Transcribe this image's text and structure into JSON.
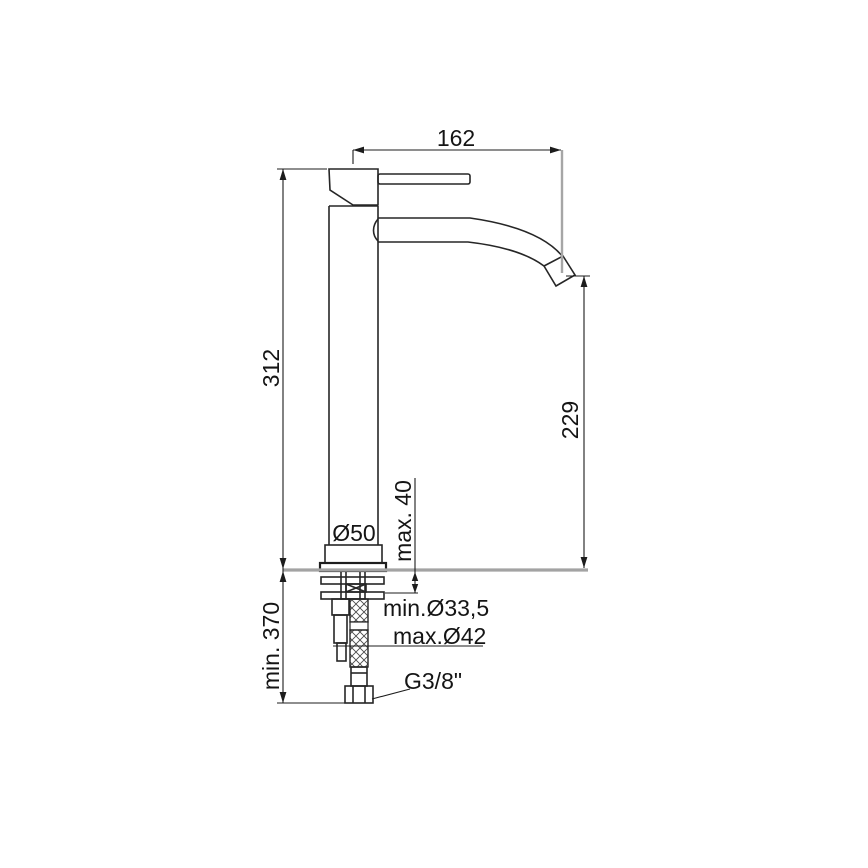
{
  "drawing": {
    "title": "Single-lever tall basin mixer tap - dimensional technical drawing",
    "dimensions": {
      "spout_reach": "162",
      "body_height": "312",
      "spout_outlet_height": "229",
      "deck_thickness": "max. 40",
      "base_diameter": "Ø50",
      "hole_min_diameter": "min.Ø33,5",
      "hole_max_diameter": "max.Ø42",
      "hose_length_below": "min. 370",
      "connection_thread": "G3/8\""
    },
    "colors": {
      "line": "#1c1c1c",
      "reference_gray": "#a3a3a3",
      "background": "#ffffff"
    }
  }
}
